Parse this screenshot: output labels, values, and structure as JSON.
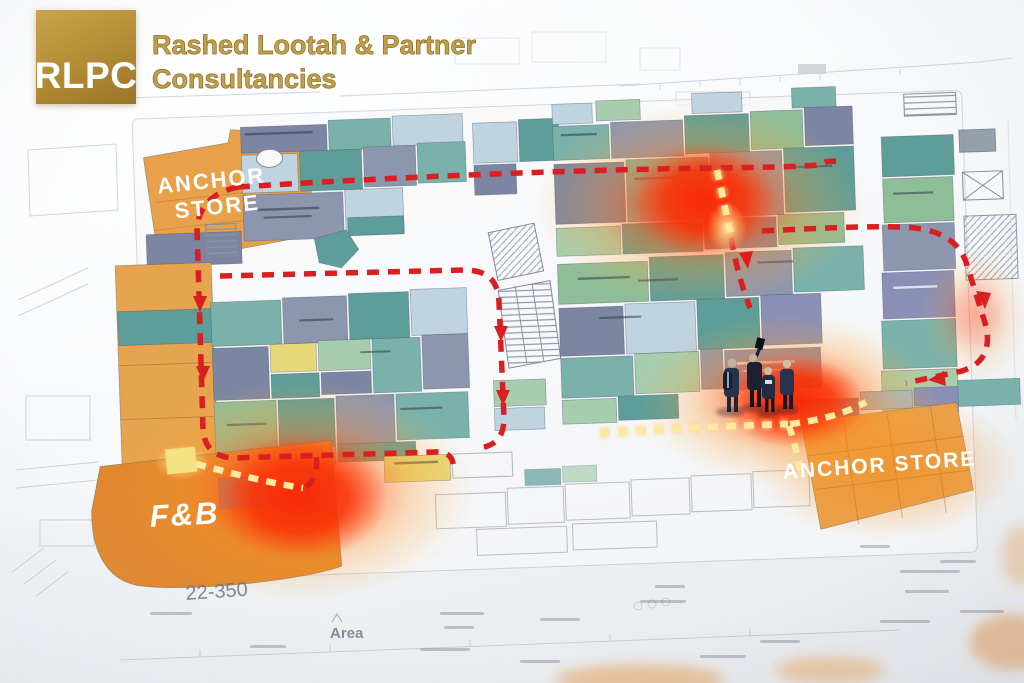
{
  "branding": {
    "logo_abbr": "RLPC",
    "company_line1": "Rashed Lootah & Partner",
    "company_line2": "Consultancies"
  },
  "plan": {
    "anchor_top": {
      "line1": "ANCHOR",
      "line2": "STORE"
    },
    "anchor_bottom": {
      "label": "ANCHOR STORE"
    },
    "fnb": {
      "label": "F&B"
    }
  },
  "annotations": {
    "dimension_note": "22-350",
    "area_note": "Area"
  },
  "colors": {
    "brand_gold": "#b08f3e",
    "route_red": "#d91f1f",
    "route_yellow": "#ffe8a0",
    "heat_core": "#f32805",
    "heat_glow": "#ff8c28",
    "anchor_orange": "#e9a04a",
    "fnb_orange": "#e1882f",
    "unit_teal": "#7ab1ab",
    "unit_slate": "#8d96af",
    "unit_green": "#8fbd98",
    "unit_yellow": "#e6d87a",
    "unit_blue": "#b9cedd",
    "unit_purple": "#8b8fb5",
    "paper": "#f4f6f8"
  }
}
